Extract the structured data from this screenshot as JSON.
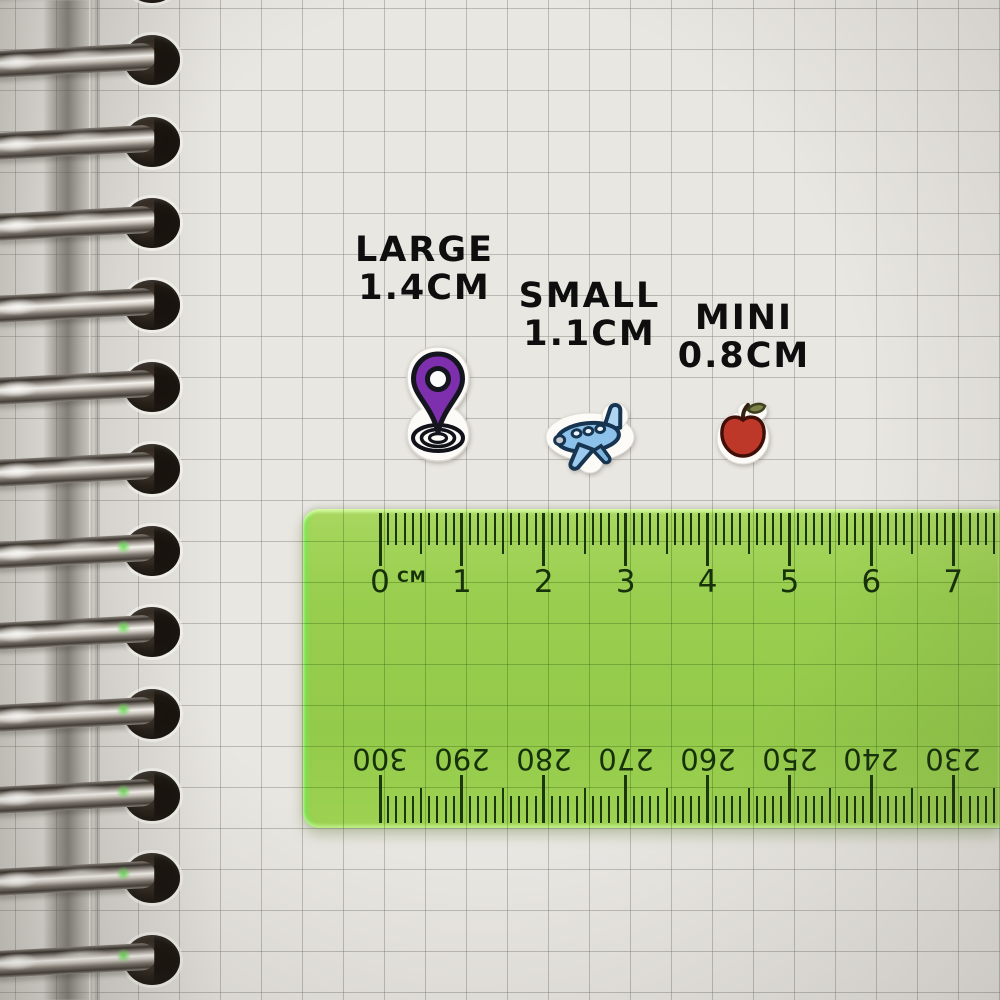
{
  "sticker_labels": [
    {
      "name": "LARGE",
      "size": "1.4CM",
      "sticker": "location-pin"
    },
    {
      "name": "SMALL",
      "size": "1.1CM",
      "sticker": "airplane"
    },
    {
      "name": "MINI",
      "size": "0.8CM",
      "sticker": "apple"
    }
  ],
  "stickers": [
    {
      "icon": "location-pin-icon",
      "fill": "#7e2fae"
    },
    {
      "icon": "airplane-icon",
      "fill": "#8cc2ea"
    },
    {
      "icon": "apple-icon",
      "fill": "#bd3829"
    }
  ],
  "ruler": {
    "unit_label": "CM",
    "cm_numbers": [
      "0",
      "1",
      "2",
      "3",
      "4",
      "5",
      "6",
      "7"
    ],
    "mm_numbers_upside_down": [
      "300",
      "290",
      "280",
      "270",
      "260",
      "250",
      "240",
      "230"
    ],
    "body_color": "#8cc94e",
    "ink_color": "#1c370d"
  },
  "notebook": {
    "ring_count": 13,
    "paper_color": "#e9e7e2",
    "grid_color": "#a9a79f"
  }
}
